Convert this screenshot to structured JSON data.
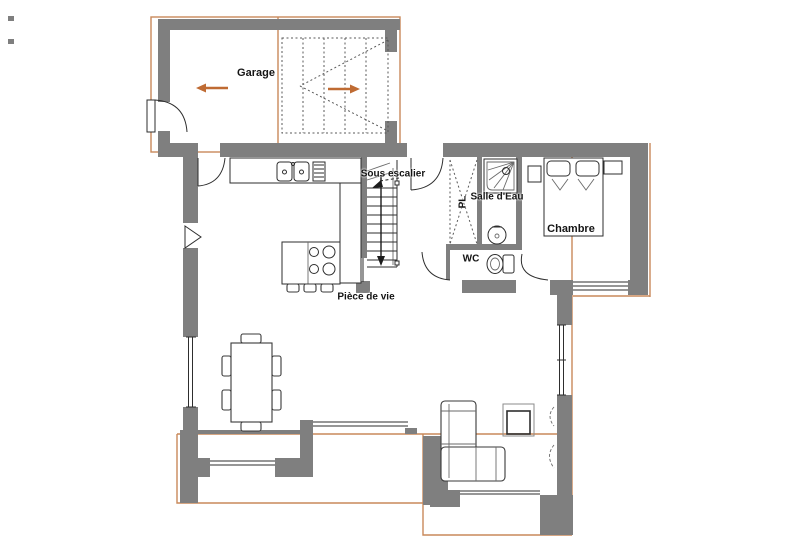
{
  "title": "Plan du rez-de-chaussée",
  "colors": {
    "bg": "#ffffff",
    "wall": "#7f7f7f",
    "ink": "#2e2e2e",
    "dotted": "#5a5a5a",
    "overlay": "#c9895a",
    "arrow": "#bf6b33"
  },
  "rooms": {
    "garage": {
      "label": "Garage"
    },
    "under_stairs": {
      "label": "Sous escalier"
    },
    "bathroom": {
      "label": "Salle d'Eau"
    },
    "closet": {
      "label": "PL"
    },
    "wc": {
      "label": "WC"
    },
    "bedroom": {
      "label": "Chambre"
    },
    "living_room": {
      "label": "Pièce de vie"
    }
  },
  "annotations": {
    "garage_arrow_direction": "left",
    "exterior_stairs_arrow_direction": "right",
    "interior_stairs_arrow_direction": "down"
  }
}
